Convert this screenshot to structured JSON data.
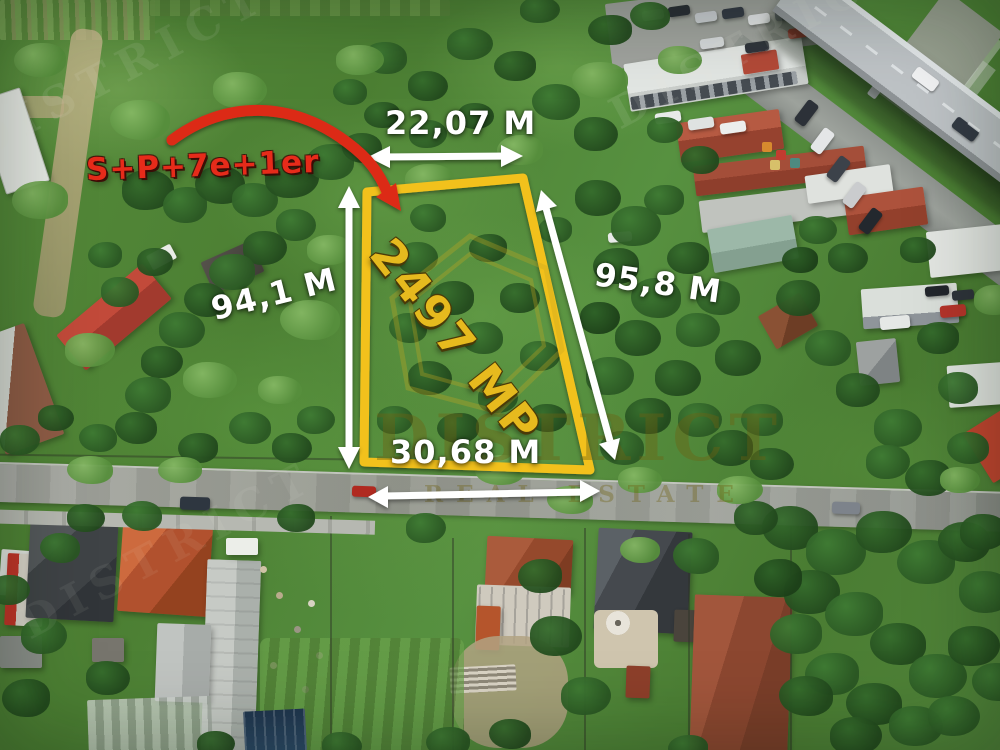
{
  "annotations": {
    "building_regime": "S+P+7e+1er",
    "area": "2497 MP",
    "width_top": "22,07 M",
    "length_left": "94,1 M",
    "length_right": "95,8 M",
    "width_bottom": "30,68 M"
  },
  "watermark": {
    "brand": "DISTRICT",
    "brand_sub": "REAL ESTATE"
  },
  "colors": {
    "plot_outline": "#F2C11F",
    "area_text": "#E6BA1E",
    "annotation_red": "#E02815",
    "dimension_text": "#FFFFFF",
    "watermark": "#6E6212"
  }
}
